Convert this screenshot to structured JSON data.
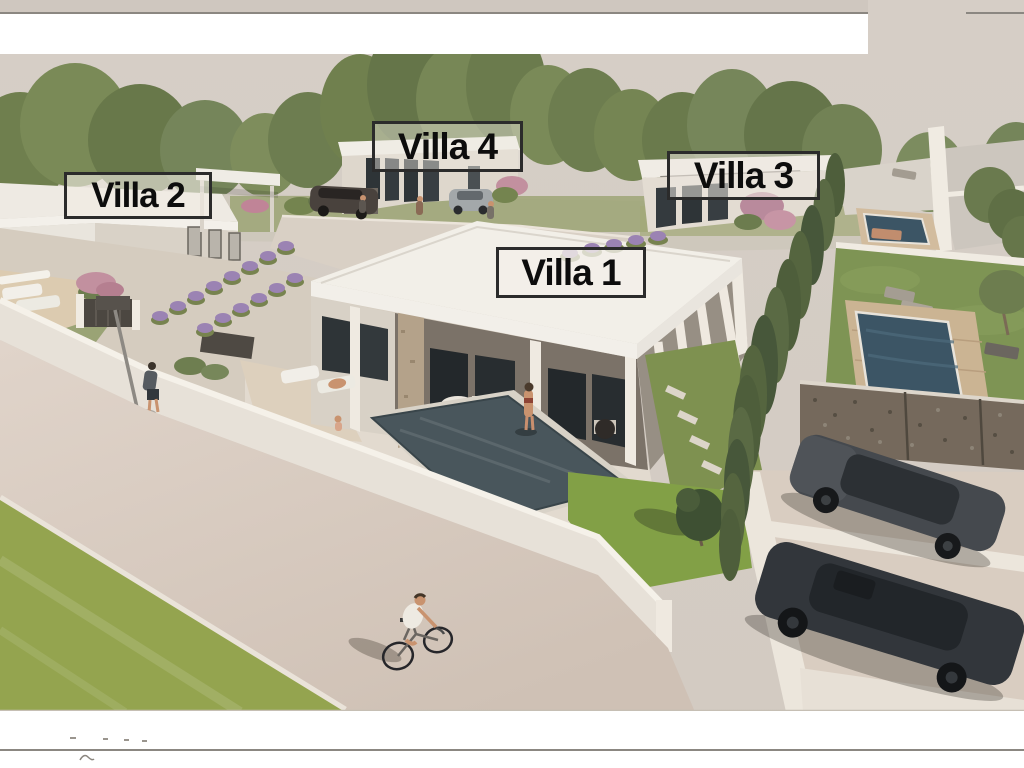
{
  "labels": {
    "villa1": "Villa 1",
    "villa2": "Villa 2",
    "villa3": "Villa 3",
    "villa4": "Villa 4"
  },
  "palette": {
    "sky": "#d4ccc4",
    "tree_green": "#74844f",
    "tree_dark": "#5d6d41",
    "tree_light": "#8a9865",
    "grass_bright": "#94a44f",
    "lawn_green": "#7e9454",
    "south_lawn": "#82a046",
    "road_beige": "#d9cdc1",
    "wall_white": "#e7e1d8",
    "roof_white": "#f2efe8",
    "facade_beige": "#d7d0c5",
    "shadow_brown": "#7b7268",
    "glass_dark": "#2e3437",
    "pool_slate": "#49565c",
    "pool_blue": "#3c5565",
    "gabion_brown": "#75695c",
    "car_dark": "#45494e",
    "car_darker": "#32363b",
    "lavender_purple": "#9b83b3",
    "flower_pink": "#c2909f",
    "skin_tan": "#c9936f",
    "top_strip_beige": "#cfc7bf",
    "frame_line_grey": "#8b8781"
  }
}
